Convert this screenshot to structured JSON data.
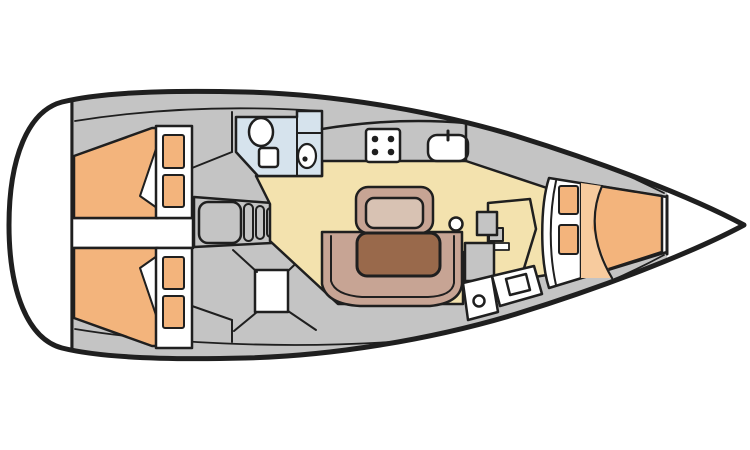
{
  "canvas": {
    "width": 750,
    "height": 450,
    "background": "#ffffff"
  },
  "palette": {
    "white": "#ffffff",
    "outline": "#1f1f1f",
    "deck": "#c4c4c4",
    "bed": "#f3b47c",
    "bed_light": "#f7cb9e",
    "floor": "#f3e2ae",
    "bath": "#d6e3ed",
    "settee": "#c7a494",
    "settee_light": "#d8c2b3",
    "table": "#99694b"
  },
  "features": {
    "galley_burners": 4,
    "aft_cabins": 2,
    "pillows_per_aft_cabin": 2,
    "v_berth_pillows": 2
  }
}
